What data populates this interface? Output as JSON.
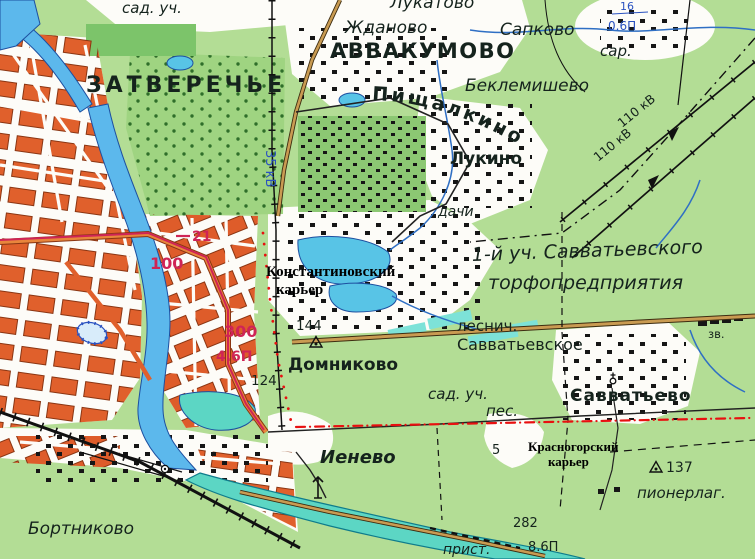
{
  "map": {
    "kind": "soviet-topographic-map",
    "area": "Tver — Zatverechye / Savvatyevo vicinity"
  },
  "colors": {
    "field_green": "#b3dd95",
    "orchard_green": "#8cc873",
    "urban_white": "#fdfcf8",
    "block_orange": "#e0602c",
    "river_blue": "#5cb8ec",
    "volga_turquoise": "#5cd6c4",
    "lake_cyan": "#58c4e6",
    "peat_cyan": "#7de2d8",
    "road_tan": "#c99b52",
    "route_magenta": "#cf2456",
    "boundary_red": "#e81010",
    "hydro_label_blue": "#2a52c0",
    "ink_black": "#151515"
  },
  "labels": {
    "sad_uch_top": "сад. уч.",
    "zatverechye": "ЗАТВЕРЕЧЬЕ",
    "lukatovo": "Лукатово",
    "zhdanovo": "Жданово",
    "sapkovo": "Сапково",
    "avvakumovo": "Аввакумово",
    "stream_width": "16",
    "stream_depth": "0.6П",
    "sar": "сар.",
    "beklemishevo": "Беклемишево",
    "pishchalkino": "Пищалкино",
    "lukino": "Лукино",
    "kv110_a": "110 кВ",
    "kv110_b": "110 кВ",
    "kv35": "35 кВ",
    "dachi": "дачи",
    "uch1": "1-й уч. Савватьевского",
    "torfo": "торфопредприятия",
    "konst_line1": "Константиновский",
    "konst_line2": "карьер",
    "lesnich": "леснич.",
    "savvatyevskoye": "Савватьевское",
    "n144": "144",
    "n300": "300",
    "n46p": "4.6П",
    "n124": "124",
    "n21": "21",
    "n100": "100",
    "domnikovo": "Домниково",
    "sad_uch_2": "сад. уч.",
    "pes": "пес.",
    "n5": "5",
    "ienevo": "Иенево",
    "krasn_line1": "Красногорский",
    "krasn_line2": "карьер",
    "n137": "137",
    "pionerlag": "пионерлаг.",
    "savvatyevo": "Савватьево",
    "n282": "282",
    "n86p": "8.6П",
    "prist": "прист.",
    "bortnikovo": "Бортниково",
    "zv": "зв."
  }
}
